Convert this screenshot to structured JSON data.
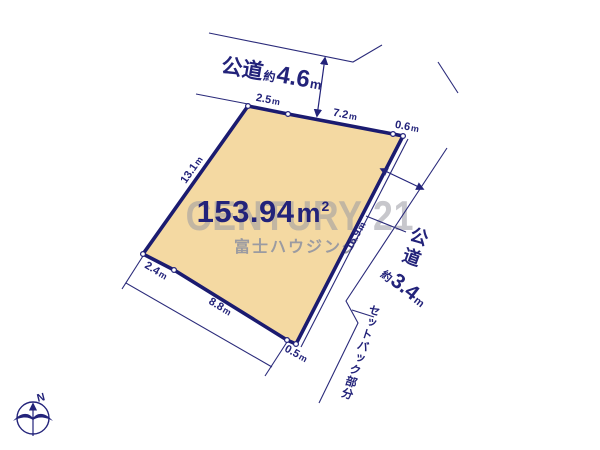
{
  "plot": {
    "area": {
      "value": "153.94",
      "unit_base": "m",
      "unit_sup": "2"
    },
    "edges": {
      "top_a": {
        "v": "2.5",
        "u": "m"
      },
      "top_b": {
        "v": "7.2",
        "u": "m"
      },
      "ne": {
        "v": "0.6",
        "u": "m"
      },
      "left": {
        "v": "13.1",
        "u": "m"
      },
      "right": {
        "v": "16.9",
        "u": "m"
      },
      "sw": {
        "v": "2.4",
        "u": "m"
      },
      "bottom": {
        "v": "8.8",
        "u": "m"
      },
      "se": {
        "v": "0.5",
        "u": "m"
      }
    }
  },
  "roads": {
    "top": {
      "name": "公道",
      "approx": "約",
      "value": "4.6",
      "unit": "m"
    },
    "right": {
      "name": "公道",
      "approx": "約",
      "value": "3.4",
      "unit": "m"
    }
  },
  "setback": {
    "label": "セットバック部分"
  },
  "watermark": {
    "brand": "CENTURY 21",
    "company": "富士ハウジング"
  },
  "compass": {
    "north": "N"
  },
  "colors": {
    "line_navy": "#23237A",
    "plot_border": "#1B1B70",
    "plot_fill": "#F4D9A2",
    "watermark_gray": "#9B9BA1"
  }
}
